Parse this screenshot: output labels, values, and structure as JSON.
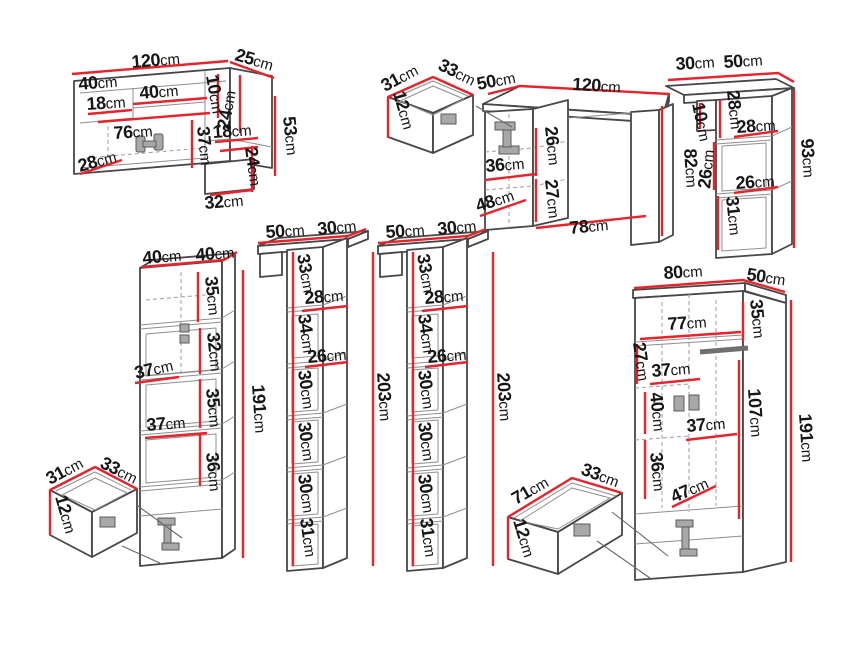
{
  "unit": "cm",
  "colors": {
    "dimension_line": "#e8232a",
    "outline": "#474747",
    "text": "#161616",
    "background": "#ffffff"
  },
  "pieces": {
    "wall_shelf": {
      "dims": {
        "total_width": "120cm",
        "side_depth": "25cm",
        "top_shelf_width": "40cm",
        "left_opening_height": "18cm",
        "middle_opening_width": "40cm",
        "middle_opening_height": "10cm",
        "right_upper_height": "24cm",
        "right_opening_height": "18cm",
        "right_lower_height": "24cm",
        "total_height": "53cm",
        "interior_width": "76cm",
        "interior_height": "37cm",
        "bottom_depth": "28cm",
        "lower_box_width": "32cm"
      }
    },
    "drawer_small_1": {
      "dims": {
        "depth": "31cm",
        "width": "33cm",
        "height": "12cm"
      }
    },
    "desk": {
      "dims": {
        "depth": "50cm",
        "width": "120cm",
        "drawer_section_height": "26cm",
        "cabinet_inner_width": "36cm",
        "lower_section_height": "27cm",
        "base_depth": "48cm",
        "legroom_width": "78cm",
        "total_height": "82cm"
      }
    },
    "wall_column": {
      "dims": {
        "shelf_depth": "30cm",
        "shelf_width": "50cm",
        "lip_height": "10cm",
        "upper_section_height": "28cm",
        "upper_opening_width": "28cm",
        "middle_opening_height": "26cm",
        "middle_opening_width": "26cm",
        "lower_opening_height": "31cm",
        "total_height": "93cm"
      }
    },
    "drawer_small_2": {
      "dims": {
        "depth": "31cm",
        "width": "33cm",
        "height": "12cm"
      }
    },
    "tall_cabinet": {
      "dims": {
        "width": "40cm",
        "depth": "40cm",
        "section1_height": "35cm",
        "section2_height": "32cm",
        "shelf_depth_upper": "37cm",
        "section3_height": "35cm",
        "shelf_depth_lower": "37cm",
        "section4_height": "36cm",
        "total_height": "191cm"
      }
    },
    "shelf_column_1": {
      "dims": {
        "width": "50cm",
        "depth": "30cm",
        "top_section_height": "33cm",
        "upper_opening_width": "28cm",
        "section2_height": "34cm",
        "lower_opening_width": "26cm",
        "section3_height": "30cm",
        "section4_height": "30cm",
        "section5_height": "30cm",
        "section6_height": "31cm",
        "total_height": "203cm"
      }
    },
    "shelf_column_2": {
      "dims": {
        "width": "50cm",
        "depth": "30cm",
        "top_section_height": "33cm",
        "upper_opening_width": "28cm",
        "section2_height": "34cm",
        "lower_opening_width": "26cm",
        "section3_height": "30cm",
        "section4_height": "30cm",
        "section5_height": "30cm",
        "section6_height": "31cm",
        "total_height": "203cm"
      }
    },
    "drawer_wide": {
      "dims": {
        "width": "71cm",
        "depth": "33cm",
        "height": "12cm"
      }
    },
    "wardrobe": {
      "dims": {
        "width": "80cm",
        "depth": "50cm",
        "top_section_height": "35cm",
        "interior_width": "77cm",
        "upper_shelf_height": "27cm",
        "shelf_depth_upper": "37cm",
        "middle_section_height": "40cm",
        "shelf_depth_middle": "37cm",
        "lower_section_height": "36cm",
        "base_depth": "47cm",
        "interior_height": "107cm",
        "total_height": "191cm"
      }
    }
  }
}
